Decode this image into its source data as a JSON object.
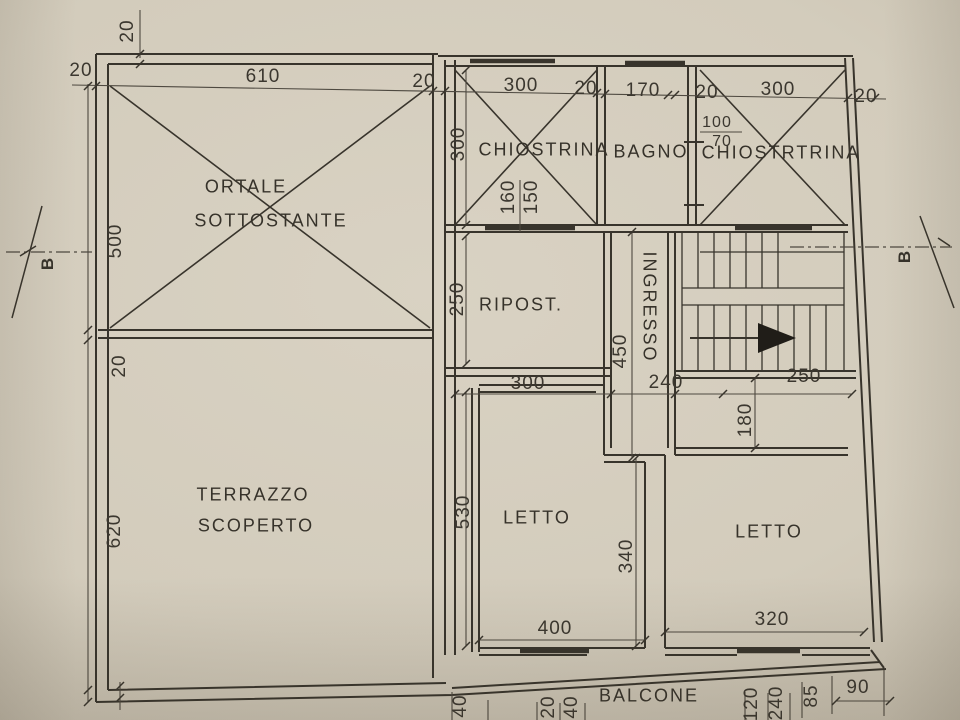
{
  "rooms": {
    "ortale": {
      "line1": "ORTALE",
      "line2": "SOTTOSTANTE"
    },
    "chiostrina": {
      "label": "CHIOSTRINA"
    },
    "bagno": {
      "label": "BAGNO"
    },
    "chiostrtrina": {
      "label": "CHIOSTRTRINA"
    },
    "ripost": {
      "label": "RIPOST."
    },
    "ingresso": {
      "label": "INGRESSO"
    },
    "terrazzo": {
      "line1": "TERRAZZO",
      "line2": "SCOPERTO"
    },
    "letto_left": {
      "label": "LETTO"
    },
    "letto_right": {
      "label": "LETTO"
    },
    "balcone": {
      "label": "BALCONE"
    }
  },
  "dimensions": {
    "top": [
      "20",
      "610",
      "20",
      "300",
      "20",
      "170",
      "20",
      "300",
      "20"
    ],
    "top_left_vertical": "20",
    "left": [
      "500",
      "20",
      "620"
    ],
    "chiostrina_height": "300",
    "chiostrina_windows": [
      "160",
      "150"
    ],
    "bagno_window": {
      "num": "100",
      "den": "70"
    },
    "ripost_height": "250",
    "ripost_width": "300",
    "ingresso_length": "450",
    "corridor_width": "240",
    "stair_width": "250",
    "letto_right_offset": "180",
    "letto_left_height": "530",
    "letto_left_inner": "340",
    "letto_left_width": "400",
    "letto_right_width": "320",
    "bottom": [
      "40",
      "20",
      "40",
      "120",
      "240",
      "85",
      "90"
    ]
  },
  "section_marks": {
    "left": "B",
    "right": "B"
  },
  "drawing_colors": {
    "ink": "#38342c",
    "thin_ink": "#4e4940",
    "paper": "#d3ccbc",
    "arrow_fill": "#201d18"
  }
}
